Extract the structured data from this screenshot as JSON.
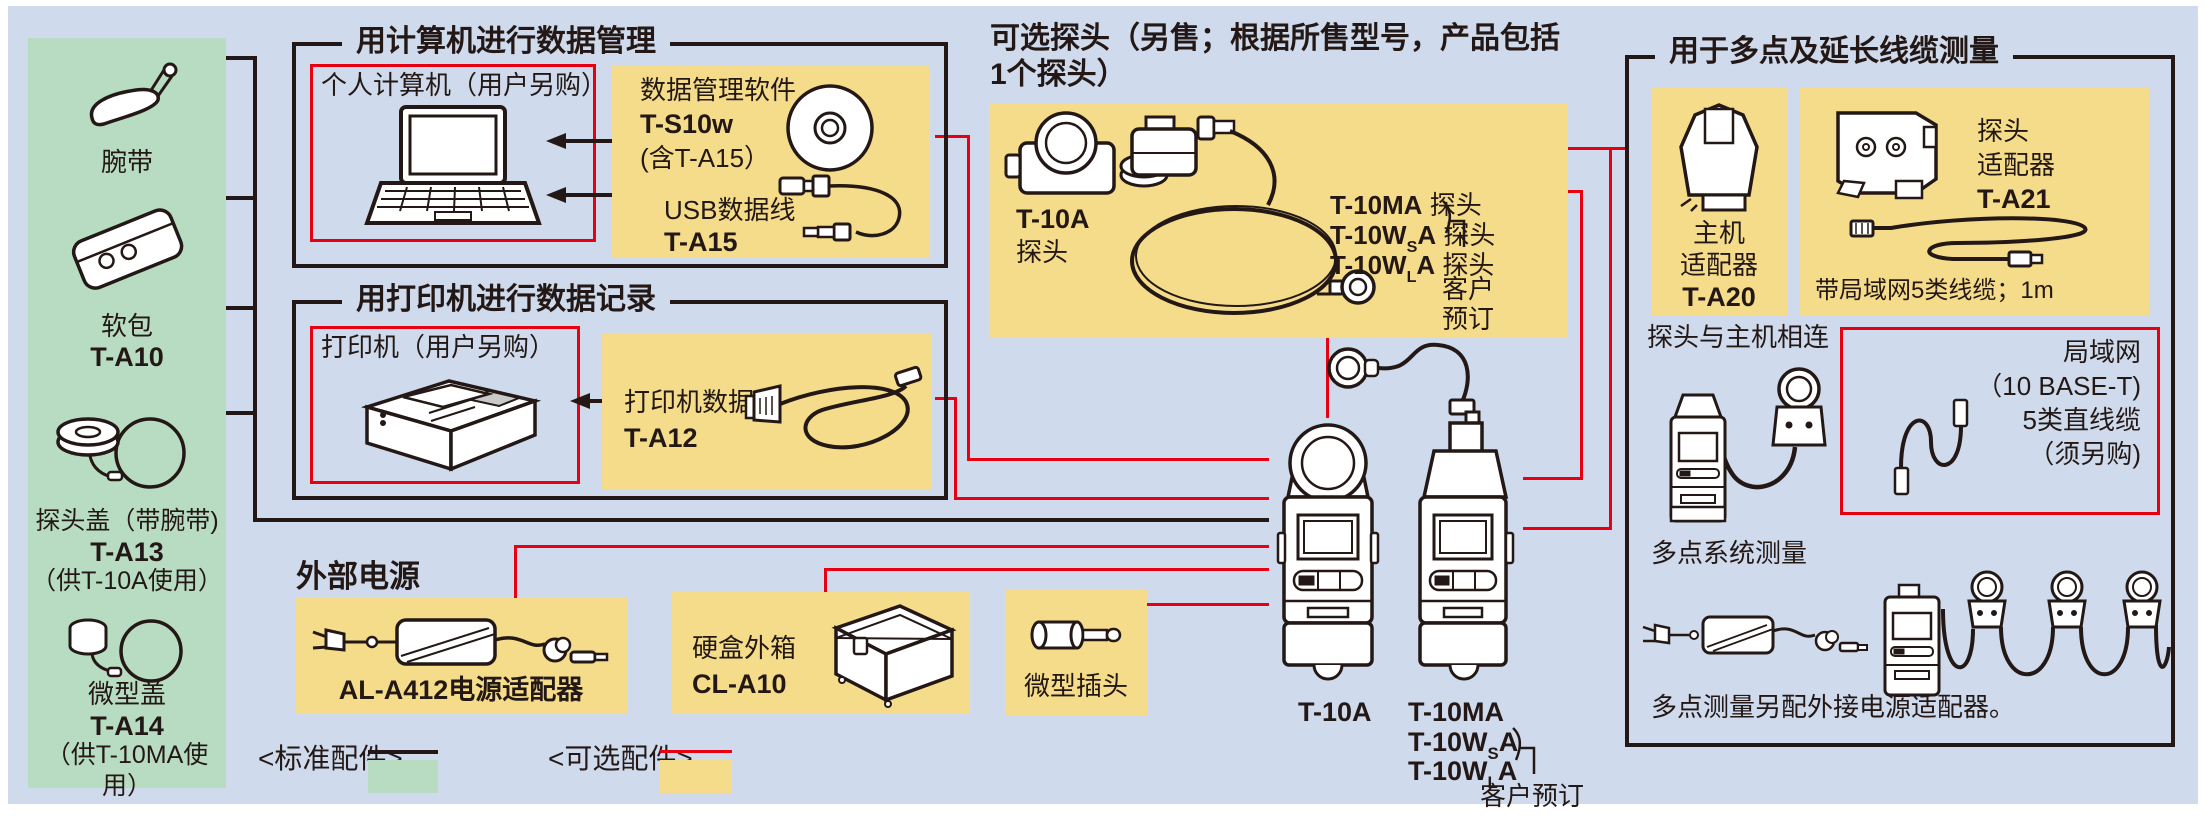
{
  "colors": {
    "diagram_bg": "#cfdbec",
    "standard_green": "#b8dcc2",
    "optional_yellow": "#f5dc8a",
    "line_black": "#231815",
    "line_red": "#e60012"
  },
  "standard_panel": {
    "item1_label": "腕带",
    "item2_label": "软包",
    "item2_model": "T-A10",
    "item3_label": "探头盖（带腕带)",
    "item3_model": "T-A13",
    "item3_note": "（供T-10A使用）",
    "item4_label": "微型盖",
    "item4_model": "T-A14",
    "item4_note": "（供T-10MA使用）"
  },
  "computer_section": {
    "title": "用计算机进行数据管理",
    "pc_label": "个人计算机（用户另购）",
    "software_name": "数据管理软件",
    "software_model": "T-S10w",
    "software_note": "(含T-A15）",
    "usb_name": "USB数据线",
    "usb_model": "T-A15"
  },
  "printer_section": {
    "title": "用打印机进行数据记录",
    "printer_label": "打印机（用户另购）",
    "cable_name": "打印机数据线",
    "cable_model": "T-A12"
  },
  "probes_section": {
    "title_line1": "可选探头（另售；根据所售型号，产品包括",
    "title_line2": "1个探头）",
    "probe1_model": "T-10A",
    "probe1_label": "探头",
    "row1_model": "T-10MA",
    "row1_label": " 探头",
    "row2_prefix": "T-10W",
    "row2_sub": "S",
    "row2_suffix": "A",
    "row2_label": " 探头",
    "row3_prefix": "T-10W",
    "row3_sub": "L",
    "row3_suffix": "A",
    "row3_label": " 探头",
    "order_note1": "客户",
    "order_note2": "预订"
  },
  "power_section": {
    "title": "外部电源",
    "adapter_label": "AL-A412电源适配器",
    "case_name": "硬盒外箱",
    "case_model": "CL-A10",
    "plug_label": "微型插头"
  },
  "main_units": {
    "left_model": "T-10A",
    "right_model1": "T-10MA",
    "right_model2_prefix": "T-10W",
    "right_model2_sub": "S",
    "right_model2_suffix": "A",
    "right_model3_prefix": "T-10W",
    "right_model3_sub": "L",
    "right_model3_suffix": "A",
    "order_note": "客户预订"
  },
  "multipoint_section": {
    "title": "用于多点及延长线缆测量",
    "host_adapter_line1": "主机",
    "host_adapter_line2": "适配器",
    "host_adapter_model": "T-A20",
    "probe_adapter_line1": "探头",
    "probe_adapter_line2": "适配器",
    "probe_adapter_model": "T-A21",
    "probe_adapter_note": "带局域网5类线缆；1m",
    "connect_label": "探头与主机相连",
    "lan_line1": "局域网",
    "lan_line2": "（10 BASE-T)",
    "lan_line3": "5类直线缆",
    "lan_line4": "（须另购)",
    "multi_label": "多点系统测量",
    "multi_note": "多点测量另配外接电源适配器。"
  },
  "legend": {
    "standard_label": "<标准配件>",
    "optional_label": "<可选配件>"
  }
}
